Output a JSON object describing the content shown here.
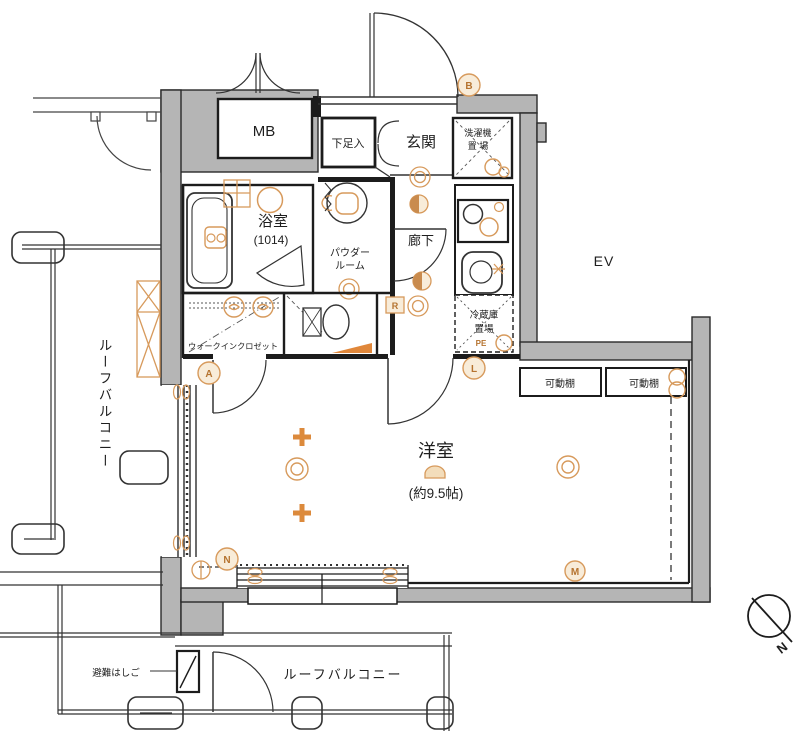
{
  "plan": {
    "rooms": {
      "mb": "MB",
      "shoe_cabinet": "下足入",
      "entrance": "玄関",
      "laundry_l1": "洗濯機",
      "laundry_l2": "置 場",
      "bathroom_l1": "浴室",
      "bathroom_l2": "(1014)",
      "powder_l1": "パウダー",
      "powder_l2": "ルーム",
      "hallway": "廊下",
      "elevator": "EV",
      "walk_in_closet": "ウォークインクロゼット",
      "fridge_l1": "冷蔵庫",
      "fridge_l2": "置場",
      "fridge_pe": "PE",
      "shelf_1": "可動棚",
      "shelf_2": "可動棚",
      "living_l1": "洋室",
      "living_l2": "(約9.5帖)",
      "balcony_left": "ルーフバルコニー",
      "balcony_bottom": "ルーフバルコニー",
      "escape_ladder": "避難はしご"
    },
    "markers": {
      "b": "B",
      "r": "R",
      "l": "L",
      "a": "A",
      "n": "N",
      "m": "M"
    },
    "compass": {
      "north": "N"
    },
    "colors": {
      "wall": "#b5b5b5",
      "line": "#1c1c1c",
      "accent": "#d79a5c"
    }
  }
}
